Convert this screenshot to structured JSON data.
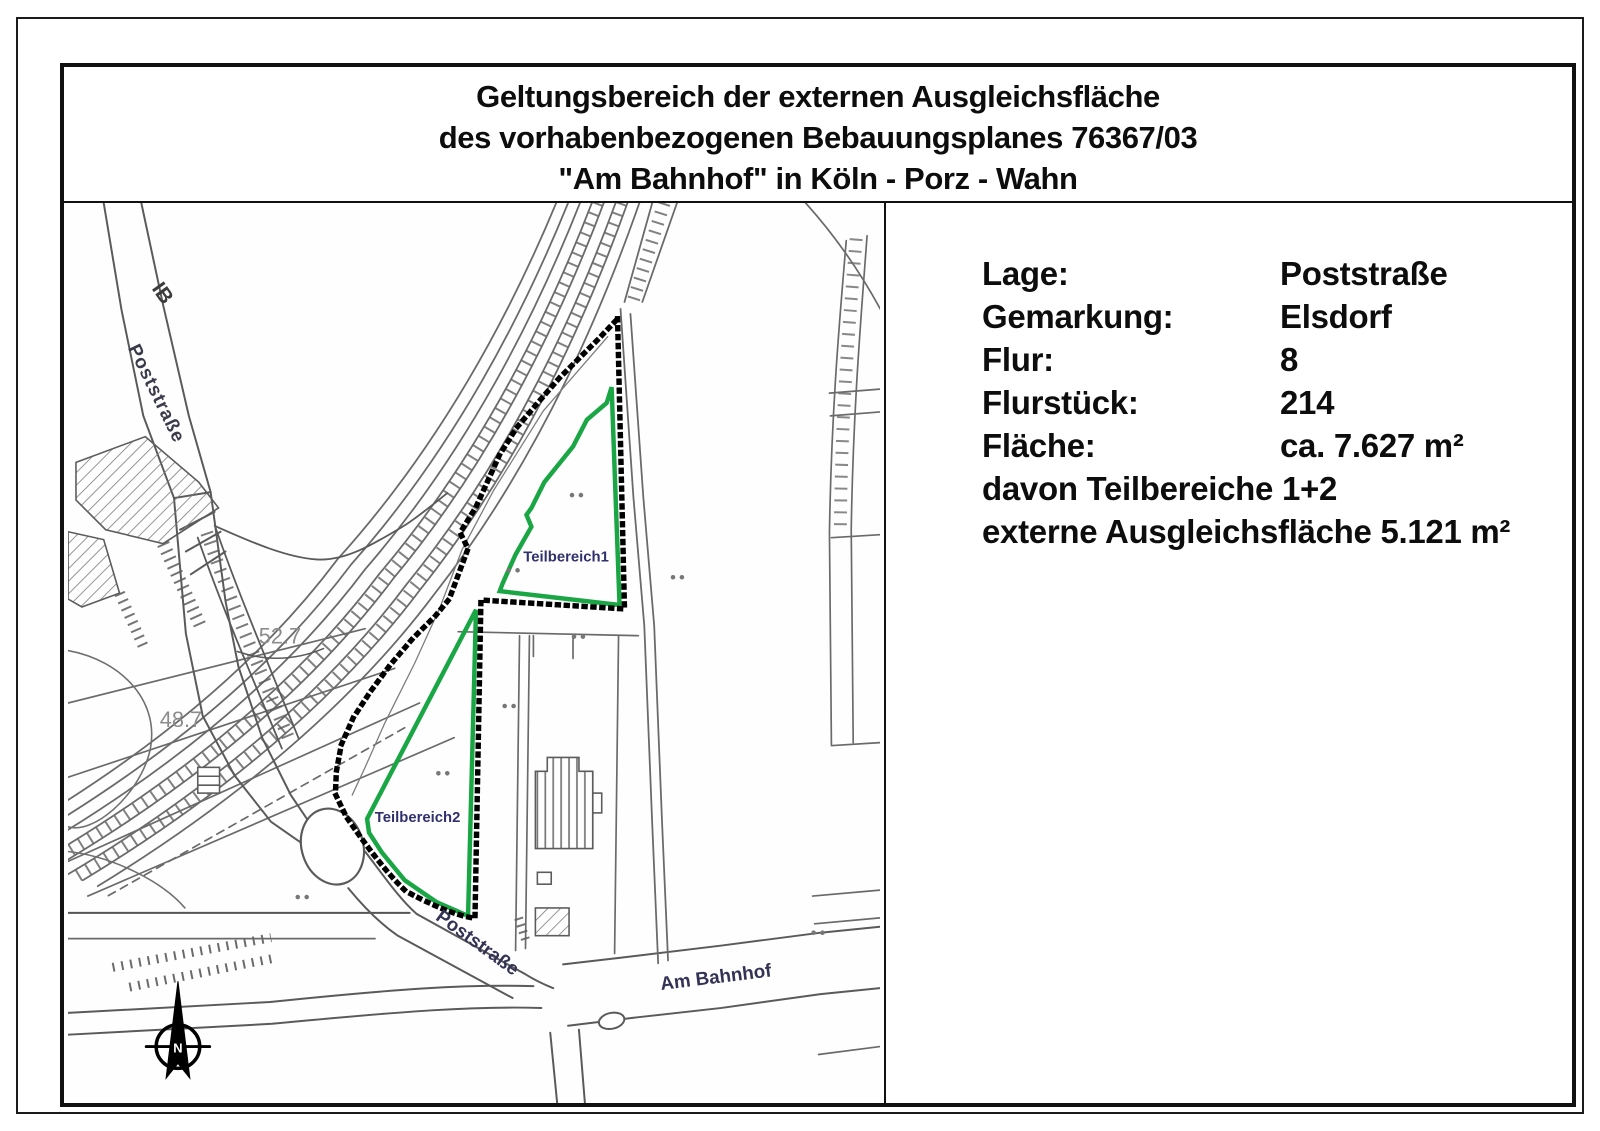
{
  "title": {
    "lines": [
      "Geltungsbereich der externen Ausgleichsfläche",
      "des vorhabenbezogenen Bebauungsplanes 76367/03",
      "\"Am Bahnhof\" in Köln - Porz - Wahn"
    ]
  },
  "info_panel": {
    "rows": [
      {
        "label": "Lage:",
        "value": "Poststraße"
      },
      {
        "label": "Gemarkung:",
        "value": "Elsdorf"
      },
      {
        "label": "Flur:",
        "value": "8"
      },
      {
        "label": "Flurstück:",
        "value": "214"
      },
      {
        "label": "Fläche:",
        "value": "ca. 7.627 m²"
      }
    ],
    "extra_lines": [
      "davon Teilbereiche 1+2",
      "externe Ausgleichsfläche 5.121 m²"
    ]
  },
  "map": {
    "labels": {
      "street_ib": "IB",
      "street_post_upper": "Poststraße",
      "street_post_lower": "Poststraße",
      "street_am_bahnhof": "Am Bahnhof",
      "area1": "Teilbereich1",
      "area2": "Teilbereich2",
      "elevation_1": "52.7",
      "elevation_2": "48.7",
      "north": "N"
    },
    "colors": {
      "boundary_green": "#1aa644",
      "dotted_black": "#000000",
      "area_label_navy": "#30306e",
      "street_label_navy": "#333355",
      "line_gray": "#5a5a5a",
      "rail_gray": "#6a6a6a",
      "elevation_gray": "#8c8c8c"
    }
  }
}
